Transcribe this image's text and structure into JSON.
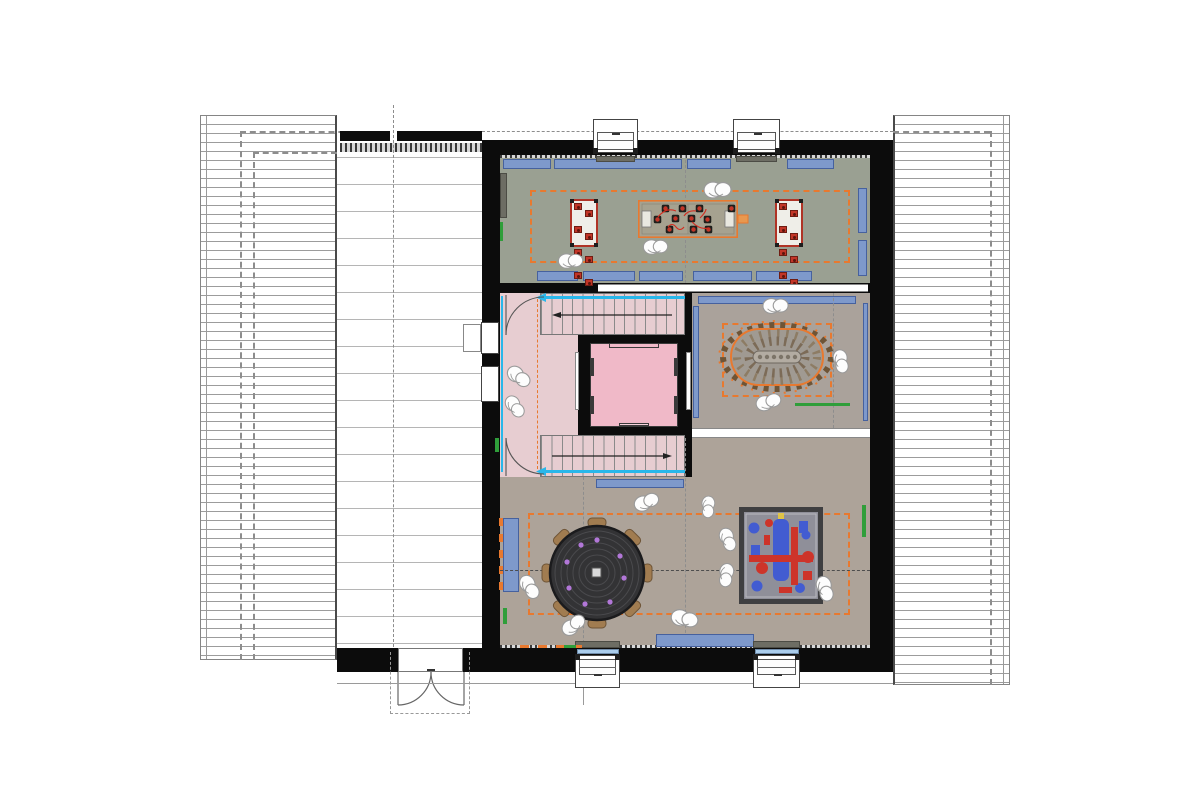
{
  "document": {
    "kind": "architectural floor plan (attic storey), presentation style with colored floors",
    "visible_text": [],
    "orientation": "plan view, roofs drawn left and right of the central building"
  },
  "colors": {
    "wall": "#0c0c0c",
    "line": "#8a8a8a",
    "roof_line": "#9c9c9c",
    "floor_green": "#9aa092",
    "floor_pink": "#e7cdd1",
    "pink_bright": "#f0b9c8",
    "floor_tan": "#aaa29b",
    "floor_tan2": "#ada399",
    "bench_blue": "#7e99cb",
    "bench_blue_border": "#46619e",
    "light_blue": "#aacdec",
    "orange": "#e8792f",
    "red": "#c23527",
    "red_dark": "#b03326",
    "green": "#2f9e3a",
    "cyan": "#29b7ea",
    "table_dark": "#333335",
    "purple": "#b277d8",
    "chair_brown": "#a17c50",
    "chair_brown_dark": "#6e5436",
    "rug_border": "#3f3f41",
    "rug_bg": "#8f8f99",
    "rug_blue": "#3a57d8",
    "rug_red": "#d42b1e",
    "beanbag_stroke": "#9a9a9a"
  },
  "counts": {
    "dormer_windows": 4,
    "stair_flights": 2,
    "elevators": 1,
    "bean_bags": 13,
    "foosball_table_players": 11,
    "rect_tables": 2,
    "seats_per_rect_table": 10,
    "round_table_chairs": 8,
    "oval_table": 1,
    "play_rug": 1,
    "wall_benches_blue": 14,
    "doors_double_exterior": 1,
    "interior_door_swings": 2
  }
}
